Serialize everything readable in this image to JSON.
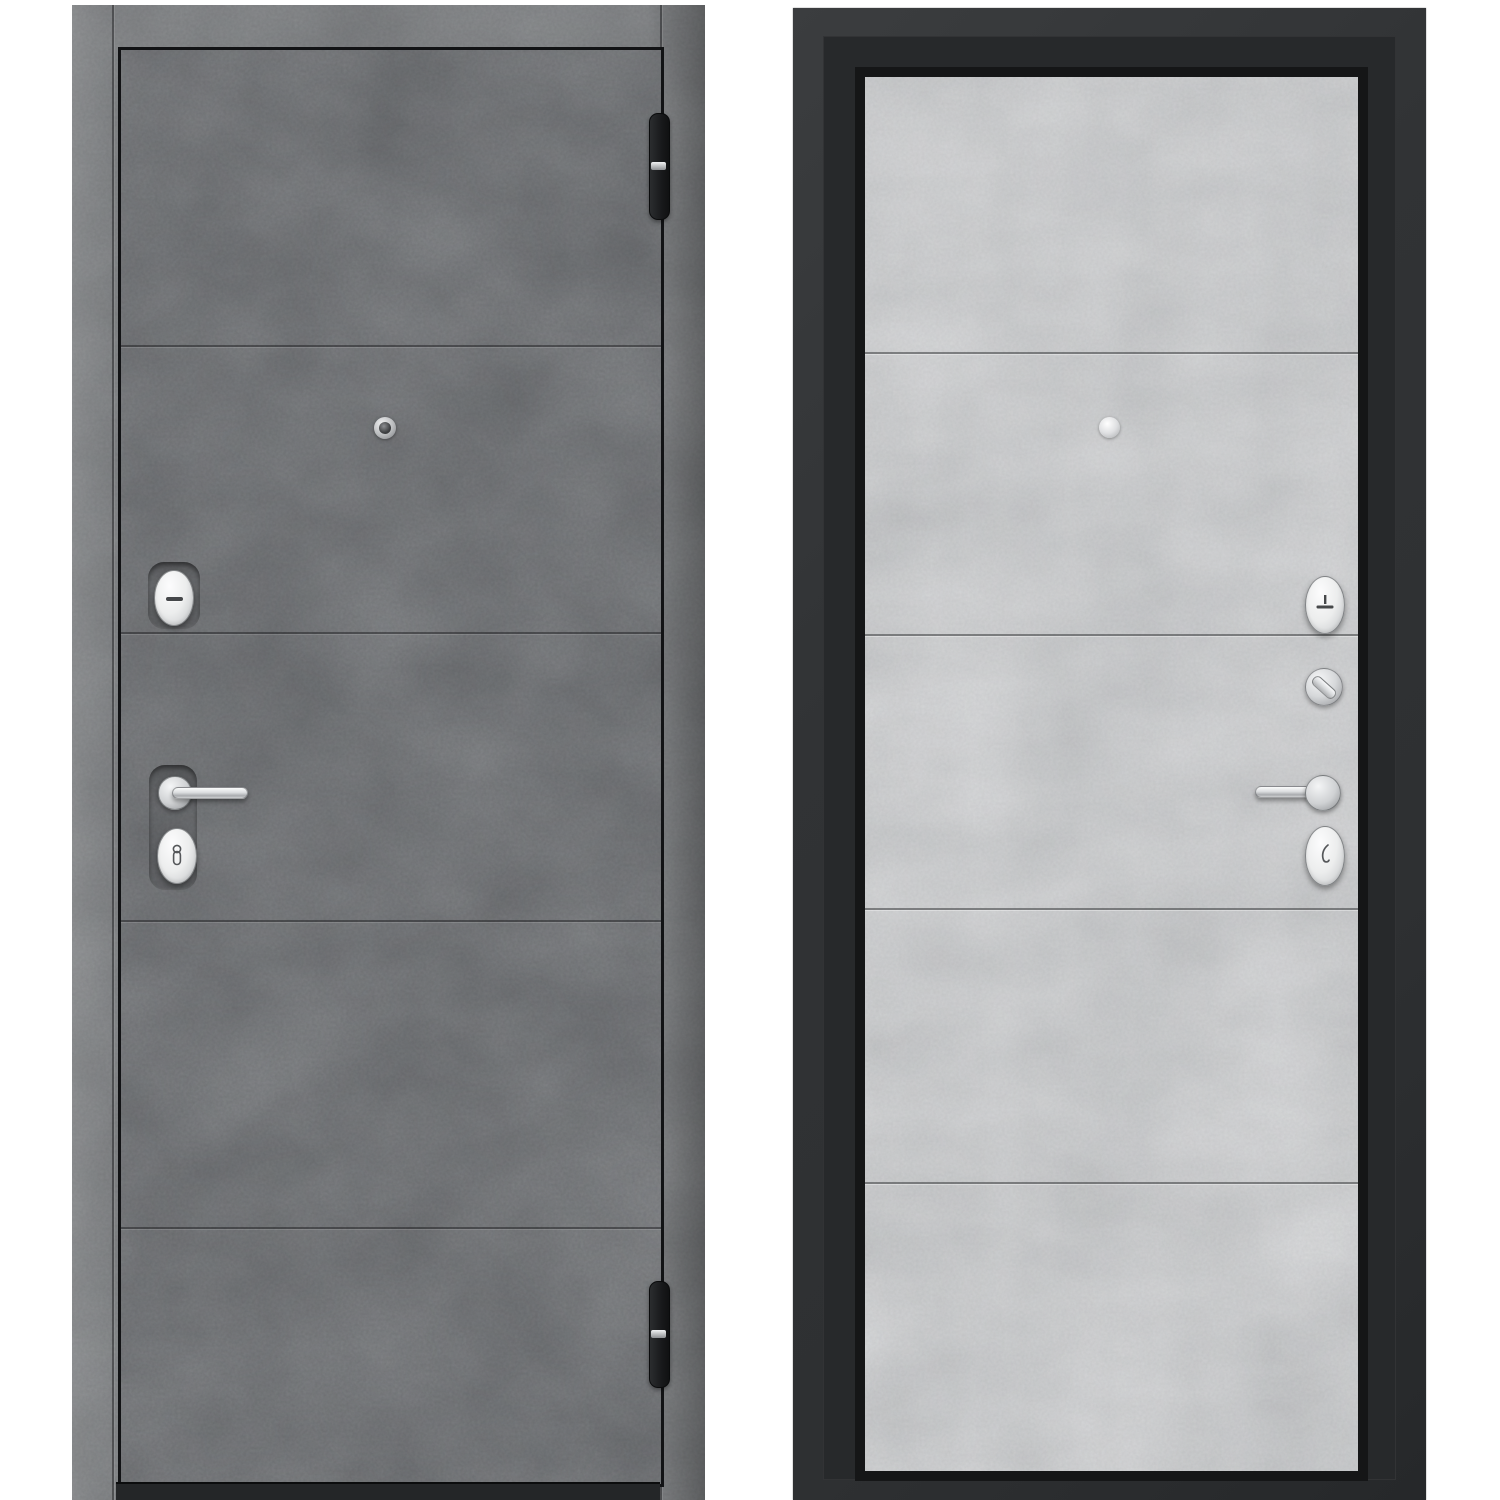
{
  "page": {
    "background": "#ffffff",
    "title": "Steel entrance door — exterior and interior views, concrete finish"
  },
  "left_door": {
    "label": "door-front-exterior-side",
    "finish_name": "dark concrete",
    "panel_count": 5,
    "groove_count": 4,
    "colors": {
      "leaf_surface": "#7b7d80",
      "frame_surface": "#8e9092",
      "gap_line": "#121315",
      "threshold": "#242628",
      "hinge_body": "#17181a",
      "hardware_chrome": "#e8e9ea"
    },
    "hardware": [
      {
        "name": "peephole",
        "finish": "chrome"
      },
      {
        "name": "upper-escutcheon",
        "finish": "chrome",
        "glyph": "horizontal-slot"
      },
      {
        "name": "lever-handle",
        "finish": "chrome",
        "orientation": "pointing-right"
      },
      {
        "name": "keyhole-escutcheon",
        "finish": "chrome",
        "glyph": "key-cylinder"
      },
      {
        "name": "hinge-top",
        "finish": "black-with-chrome-band"
      },
      {
        "name": "hinge-bottom",
        "finish": "black-with-chrome-band"
      }
    ]
  },
  "right_door": {
    "label": "door-back-interior-side",
    "finish_name": "light concrete",
    "panel_count": 5,
    "groove_count": 4,
    "colors": {
      "panel_surface": "#c6c7c9",
      "frame": "#333537",
      "frame_inner": "#27292b",
      "panel_recess": "#151617",
      "groove": "#46484a",
      "hardware_chrome": "#eef0f1"
    },
    "hardware": [
      {
        "name": "peephole",
        "finish": "chrome"
      },
      {
        "name": "night-latch-escutcheon",
        "finish": "chrome",
        "glyph": "t-bar"
      },
      {
        "name": "thumbturn-knob",
        "finish": "chrome",
        "glyph": "diagonal-lever"
      },
      {
        "name": "lever-handle",
        "finish": "chrome",
        "orientation": "pointing-left"
      },
      {
        "name": "keyhole-escutcheon",
        "finish": "chrome",
        "glyph": "hook"
      }
    ]
  }
}
